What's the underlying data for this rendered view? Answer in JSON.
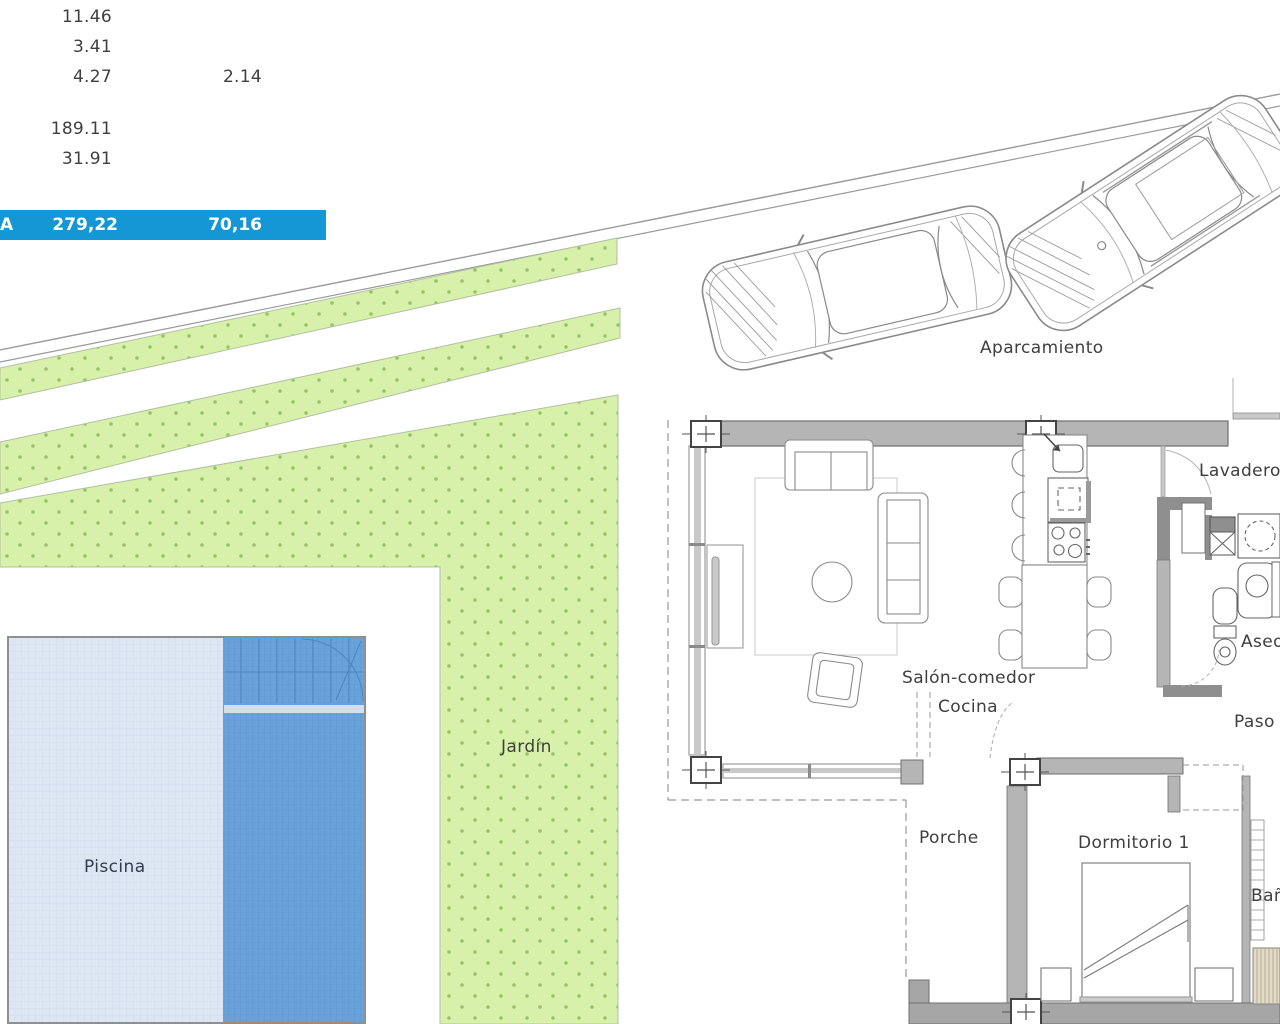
{
  "measurements": {
    "v1": "11.46",
    "v2": "3.41",
    "v3": "4.27",
    "v3b": "2.14",
    "v4": "189.11",
    "v5": "31.91",
    "total_row": {
      "label": "A",
      "total": "279,22",
      "useful": "70,16"
    }
  },
  "labels": {
    "aparcamiento": "Aparcamiento",
    "jardin": "Jardín",
    "piscina": "Piscina",
    "salon_comedor": "Salón-comedor",
    "cocina": "Cocina",
    "lavadero": "Lavadero",
    "aseo": "Aseo",
    "paso": "Paso",
    "porche": "Porche",
    "dormitorio1": "Dormitorio 1",
    "bano": "Baño"
  },
  "colors": {
    "accent_blue": "#1697d5",
    "garden_fill": "#d8f1aa",
    "garden_dot": "#95c468",
    "garden_edge": "#b2bfa0",
    "pool_light": "#dde7f4",
    "pool_grid_light": "#ccd9ec",
    "pool_dark": "#69a2da",
    "pool_grid_dark": "#5b92c9",
    "pool_step": "#4e86bd",
    "pool_band": "#d3dfef",
    "pool_border": "#8f8f8f",
    "wall_gray": "#b5b5b5",
    "wall_outline": "#6e6e6e",
    "line_gray": "#9a9a9a",
    "furn_stroke": "#8a8a8a",
    "text_dark": "#3f3f3f",
    "piscina_text": "#333c4e"
  }
}
